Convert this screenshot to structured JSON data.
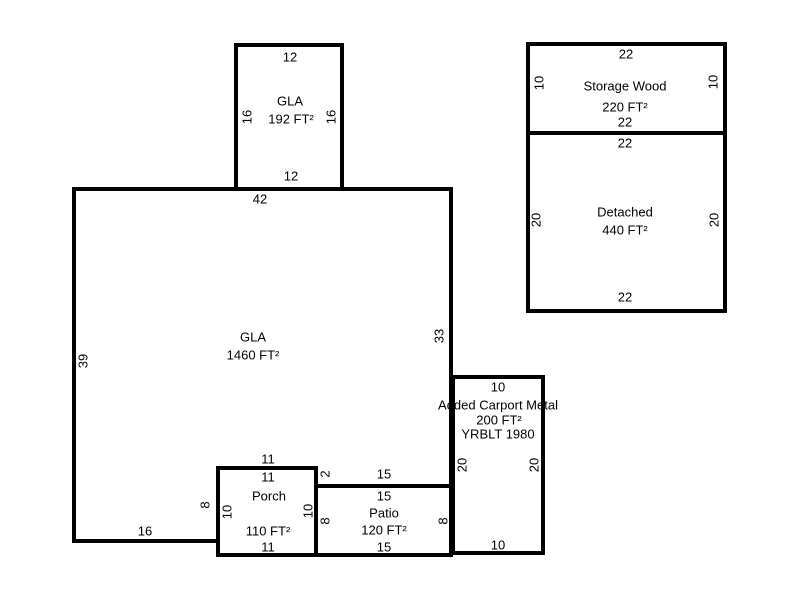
{
  "colors": {
    "background": "#ffffff",
    "line": "#000000",
    "text": "#000000"
  },
  "areas": {
    "gla_upper": {
      "label": "GLA",
      "area": "192 FT²",
      "dim_top": "12",
      "dim_left": "16",
      "dim_right": "16",
      "dim_bottom": "12"
    },
    "storage": {
      "label": "Storage Wood",
      "area": "220 FT²",
      "dim_top": "22",
      "dim_left": "10",
      "dim_right": "10",
      "dim_bottom": "22"
    },
    "detached": {
      "label": "Detached",
      "area": "440 FT²",
      "dim_top": "22",
      "dim_left": "20",
      "dim_right": "20",
      "dim_bottom": "22"
    },
    "gla_main": {
      "label": "GLA",
      "area": "1460 FT²",
      "dim_top": "42",
      "dim_left": "39",
      "dim_right": "33",
      "dim_bottom_left": "16",
      "dim_notch_left": "8",
      "dim_above_porch": "11",
      "dim_step": "2",
      "dim_above_patio": "15"
    },
    "porch": {
      "label": "Porch",
      "area": "110 FT²",
      "dim_top": "11",
      "dim_left": "10",
      "dim_right": "10",
      "dim_bottom": "11"
    },
    "patio": {
      "label": "Patio",
      "area": "120 FT²",
      "dim_top": "15",
      "dim_left": "8",
      "dim_right": "8",
      "dim_bottom": "15"
    },
    "carport": {
      "label": "Added Carport Metal",
      "area": "200 FT²",
      "year_built": "YRBLT 1980",
      "dim_top": "10",
      "dim_left": "20",
      "dim_right": "20",
      "dim_bottom": "10"
    }
  }
}
